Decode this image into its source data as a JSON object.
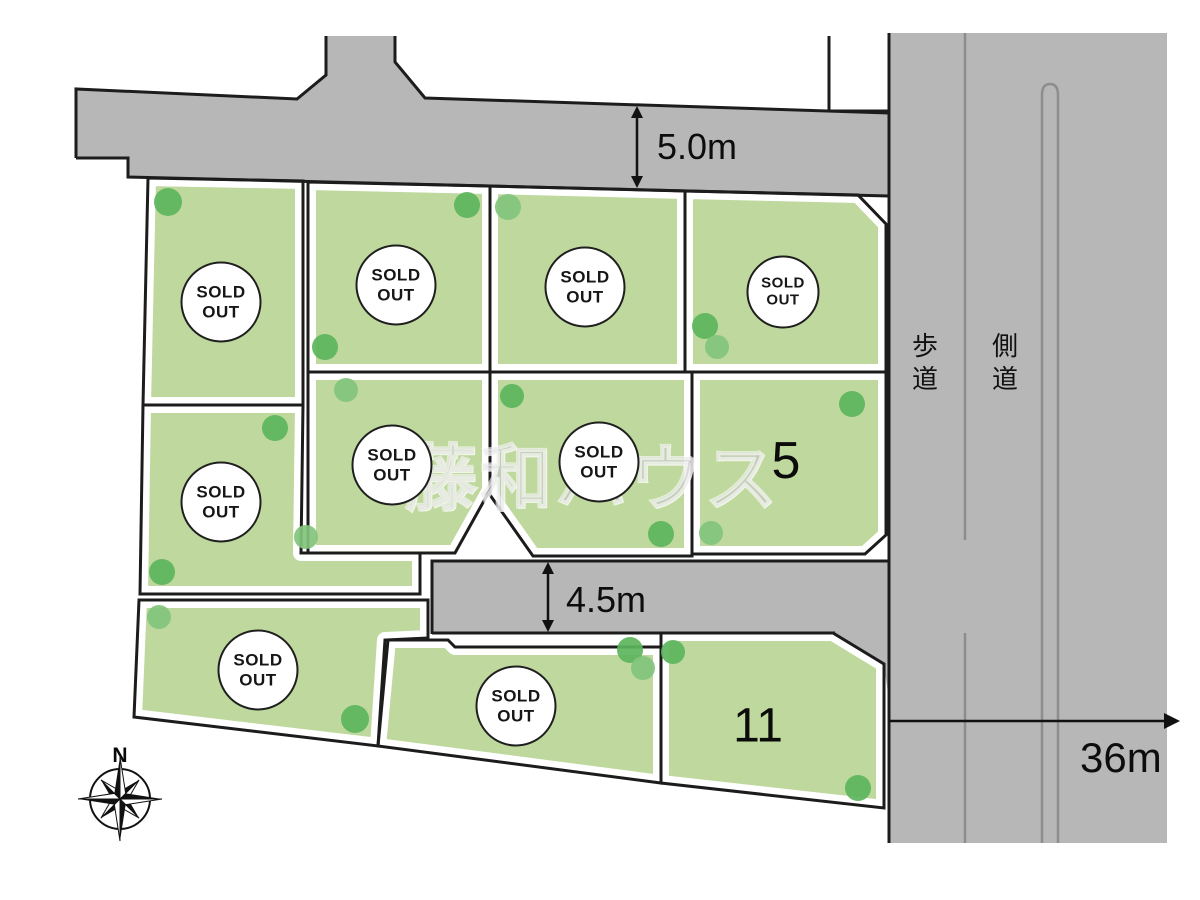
{
  "map": {
    "watermark": "藤和ハウス",
    "compass": {
      "label": "N"
    },
    "sold_badge": {
      "line1": "SOLD",
      "line2": "OUT"
    },
    "dimensions": [
      {
        "id": "top-road-width",
        "value": "5.0m"
      },
      {
        "id": "middle-road-width",
        "value": "4.5m"
      },
      {
        "id": "main-road-length",
        "value": "36m"
      }
    ],
    "road_labels": [
      {
        "id": "sidewalk",
        "text": "歩道"
      },
      {
        "id": "side-road",
        "text": "側道"
      }
    ],
    "lots": [
      {
        "id": "top-row-1",
        "status": "SOLD OUT"
      },
      {
        "id": "top-row-2",
        "status": "SOLD OUT"
      },
      {
        "id": "top-row-3",
        "status": "SOLD OUT"
      },
      {
        "id": "top-row-4",
        "status": "SOLD OUT"
      },
      {
        "id": "middle-row-1",
        "status": "SOLD OUT"
      },
      {
        "id": "middle-row-2",
        "status": "SOLD OUT"
      },
      {
        "id": "middle-row-3",
        "status": "SOLD OUT"
      },
      {
        "id": "bottom-row-1",
        "status": "SOLD OUT"
      },
      {
        "id": "bottom-row-2",
        "status": "SOLD OUT"
      },
      {
        "id": "lot-5",
        "number": "5",
        "status": "for sale"
      },
      {
        "id": "lot-11",
        "number": "11",
        "status": "for sale"
      }
    ],
    "colors": {
      "lot_green": "#bed89d",
      "road_gray": "#b7b7b7",
      "tree_green": "#5cb55c",
      "tree_green_light": "#82c47c",
      "line_black": "#1c1c1c"
    }
  }
}
